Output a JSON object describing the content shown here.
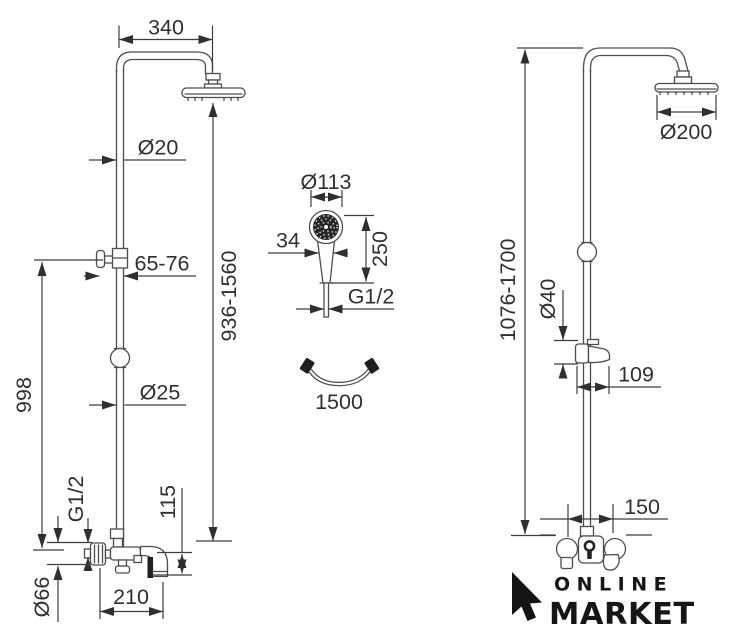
{
  "background": "#ffffff",
  "line_color": "#4d4d4d",
  "text_color": "#2f2f2f",
  "dims": {
    "left_column": {
      "arm_width": "340",
      "pipe_top_diameter": "Ø20",
      "wall_offset_range": "65-76",
      "column_height_range": "936-1560",
      "height_to_bracket": "998",
      "pipe_bottom_diameter": "Ø25",
      "inlet_thread": "G1/2",
      "spout_drop": "115",
      "spout_reach": "210",
      "escutcheon_diameter": "Ø66"
    },
    "hand_shower": {
      "head_diameter": "Ø113",
      "grip_width": "34",
      "length": "250",
      "thread": "G1/2",
      "hose_length": "1500"
    },
    "right_column": {
      "head_diameter": "Ø200",
      "column_height_range": "1076-1700",
      "holder_diameter": "Ø40",
      "holder_depth": "109",
      "connection_spacing": "150"
    }
  },
  "logo": {
    "line1": "ONLINE",
    "line2": "MARKET"
  }
}
